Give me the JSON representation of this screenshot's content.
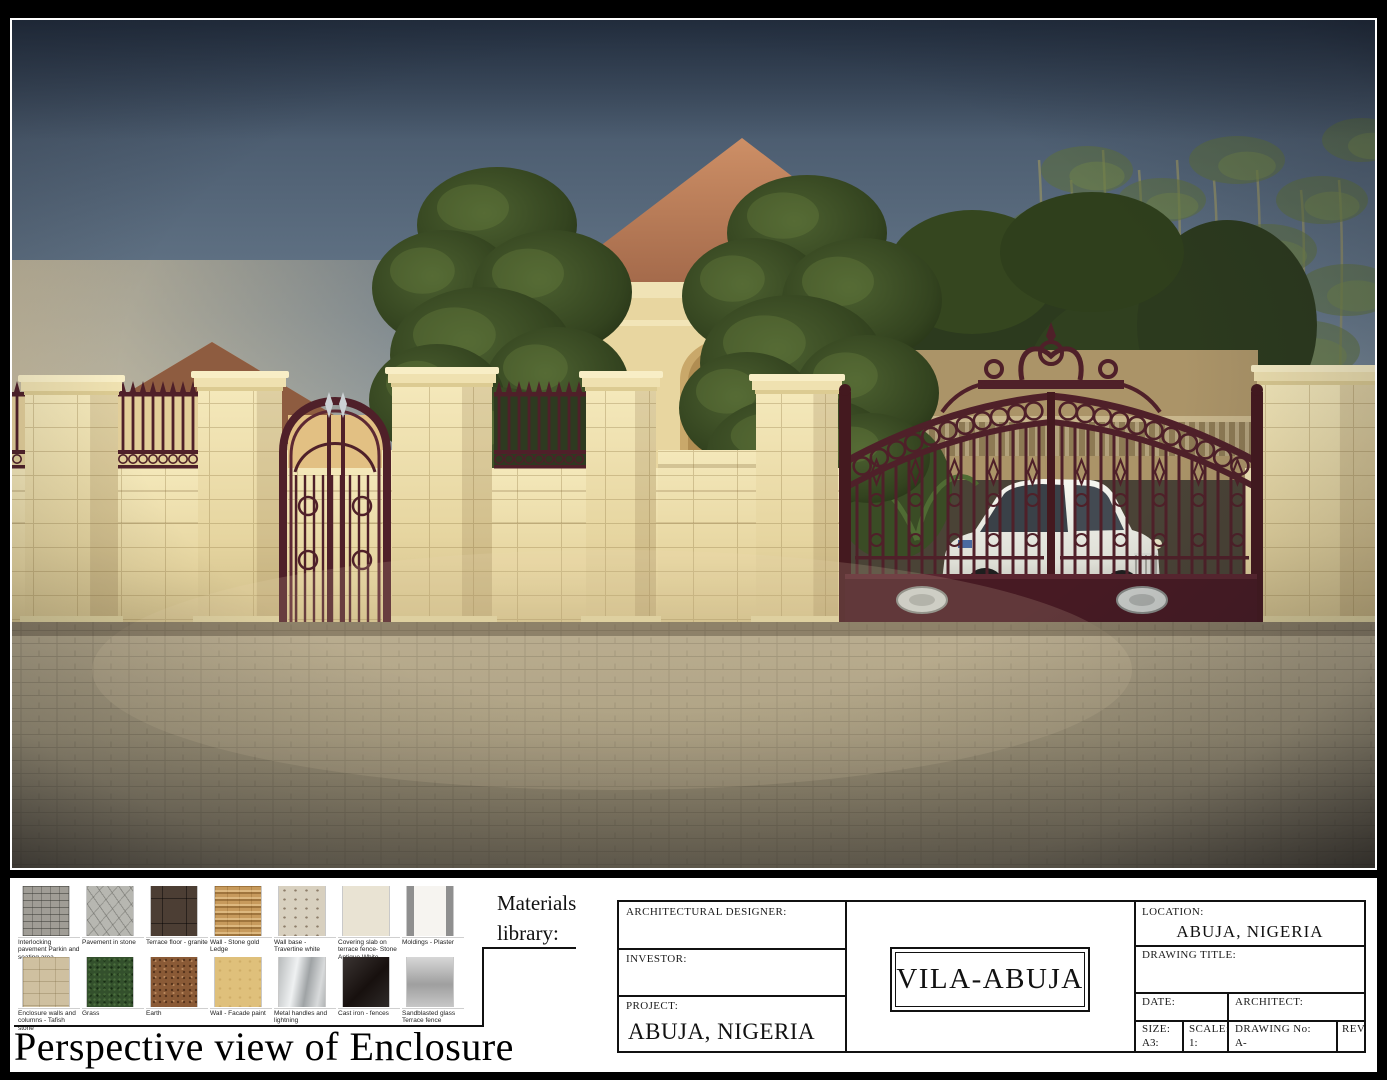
{
  "sheet": {
    "materials_library_label": "Materials library:",
    "view_title": "Perspective view of Enclosure"
  },
  "materials": {
    "items": [
      {
        "label": "Interlocking pavement Parkin and seating area",
        "swatch": "interlocking-pavement"
      },
      {
        "label": "Pavement in stone",
        "swatch": "stone-pavement"
      },
      {
        "label": "Terrace floor - granite",
        "swatch": "granite"
      },
      {
        "label": "Wall - Stone gold Ledge",
        "swatch": "gold-ledge"
      },
      {
        "label": "Wall base - Travertine white",
        "swatch": "travertine"
      },
      {
        "label": "Covering slab on terrace fence- Stone Antique White",
        "swatch": "antique-white"
      },
      {
        "label": "Moldings - Plaster",
        "swatch": "plaster"
      },
      {
        "label": "Enclosure walls and columns - Tafish stone",
        "swatch": "tafish-stone"
      },
      {
        "label": "Grass",
        "swatch": "grass"
      },
      {
        "label": "Earth",
        "swatch": "earth"
      },
      {
        "label": "Wall - Facade paint",
        "swatch": "facade-paint"
      },
      {
        "label": "Metal handles and lightning",
        "swatch": "metal"
      },
      {
        "label": "Cast iron - fences",
        "swatch": "cast-iron"
      },
      {
        "label": "Sandblasted glass Terrace fence",
        "swatch": "sandblasted-glass"
      }
    ]
  },
  "titleblock": {
    "architectural_designer_label": "ARCHITECTURAL DESIGNER:",
    "investor_label": "INVESTOR:",
    "project_label": "PROJECT:",
    "project_value": "ABUJA, NIGERIA",
    "logo": "VILA-ABUJA",
    "location_label": "LOCATION:",
    "location_value": "ABUJA, NIGERIA",
    "drawing_title_label": "DRAWING  TITLE:",
    "date_label": "DATE:",
    "architect_label": "ARCHITECT:",
    "size_label": "SIZE:",
    "size_value": "A3:",
    "scale_label": "SCALE:",
    "scale_value": "1:",
    "drawing_no_label": "DRAWING No:",
    "drawing_no_value": "A-",
    "rev_label": "REV."
  },
  "palette": {
    "sky_top": "#3c4c60",
    "sky_horizon": "#e8dcc0",
    "stone_wall": "#e9dcab",
    "roof_terracotta": "#b97a55",
    "gate_iron_maroon": "#4f2029",
    "pavement": "#a99d82",
    "tree_green": "#3c4f24",
    "car_white": "#f0f0ea"
  }
}
